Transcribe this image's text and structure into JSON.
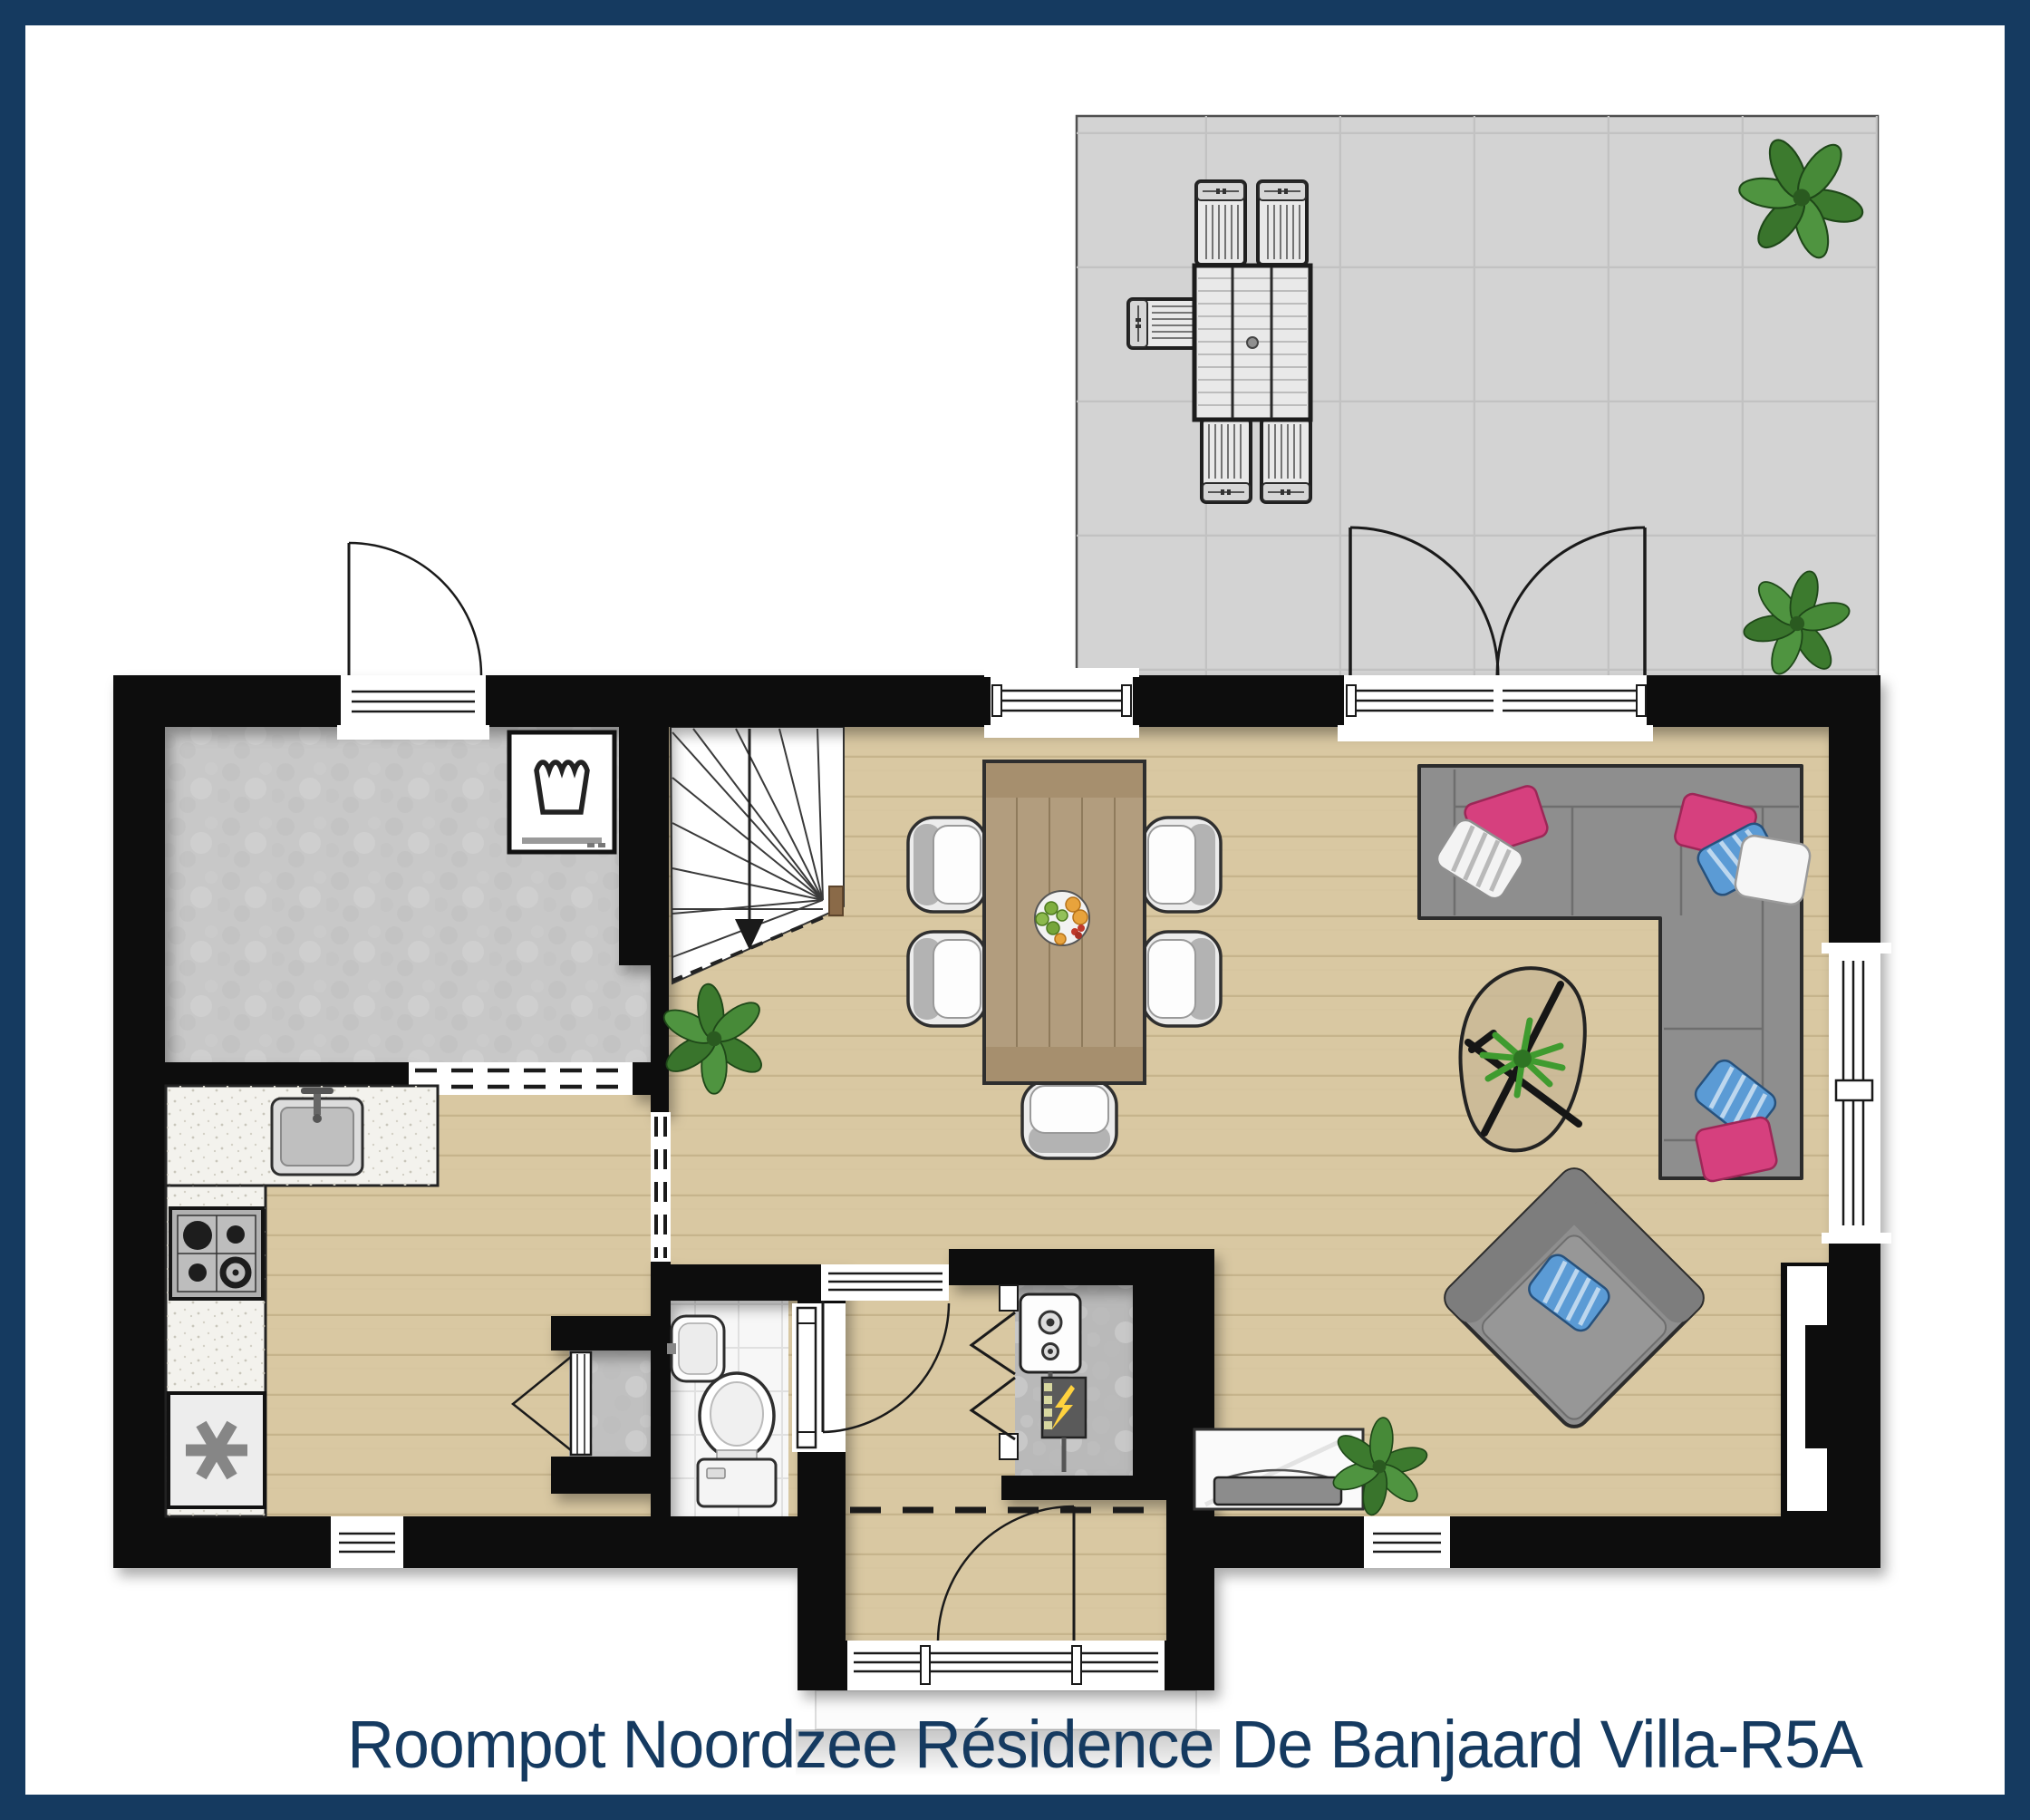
{
  "title": "Roompot Noordzee Résidence De Banjaard Villa-R5A",
  "colors": {
    "frame": "#153a60",
    "title_text": "#153a60",
    "wall": "#0e0e0e",
    "wood_floor": "#d9c8a2",
    "wood_line": "#c3b088",
    "terrace_floor": "#d3d3d3",
    "utility_floor": "#c8c8c8",
    "tile_floor": "#f7f7f7",
    "counter": "#f3f2ed",
    "concrete": "#b9b9b9",
    "sofa_gray": "#8e8e8e",
    "pillow_pink": "#d6407e",
    "pillow_blue": "#5b9bd5",
    "plant_green": "#44822f",
    "dining_table_wood": "#b29d7e",
    "outdoor_furniture": "#e9e9e9"
  },
  "icons": {
    "washing_machine_icon": "laundry wash-tub glyph",
    "freezer_icon": "✳",
    "stair_direction_icon": "▼",
    "fuse_box_icon": "⚡",
    "stove_icon": "four gas burners",
    "sink_icon": "rounded basin with faucet",
    "toilet_icon": "bowl with cistern",
    "washbasin_icon": "rounded basin with tap",
    "boiler_icon": "unit with two round gauges"
  },
  "furniture": [
    "corner-sofa-with-pillows",
    "lounge-armchair-with-pillow",
    "coffee-table-with-plant",
    "dining-table-with-fruit-bowl",
    "5-dining-chairs",
    "tv-sideboard",
    "washing-machine",
    "freezer",
    "gas-stove",
    "kitchen-sink",
    "toilet",
    "washbasin",
    "boiler",
    "fuse-box",
    "winder-staircase",
    "storage-closet",
    "outdoor-dining-table",
    "5-outdoor-chairs",
    "5-plants"
  ]
}
